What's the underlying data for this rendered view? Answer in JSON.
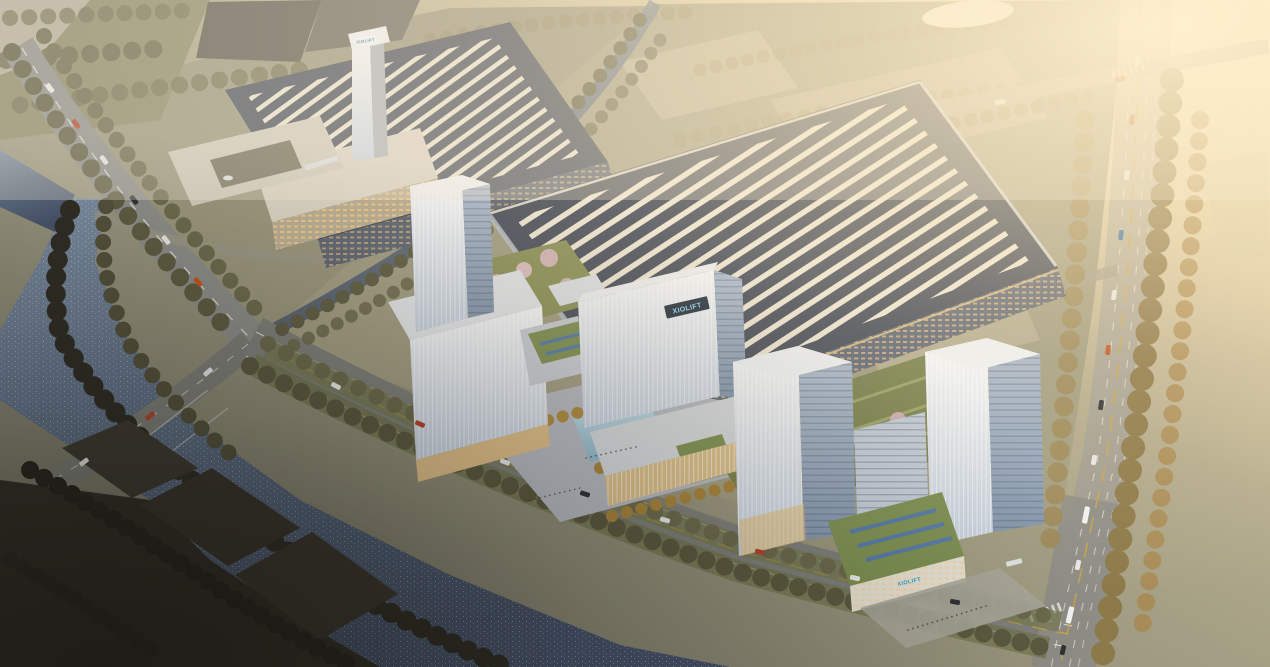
{
  "scene": {
    "brand": {
      "logo_text": "XIOLIFT",
      "logo_color": "#2d9fd8"
    },
    "palette": {
      "haze_gold": "#f9ecc8",
      "terrain_mid": "#93907a",
      "factory_roof": "#454c5a",
      "roof_stripe": "#ece5d3",
      "river_water": "#5d6d82",
      "pool_water": "#9ec6d8",
      "glass_light": "#f5f7f9",
      "glass_shade": "#8396ad",
      "podium_warm": "#e8c98f",
      "lawn_green": "#85895a",
      "green_roof": "#7d9052",
      "pv_strip": "#567aa8",
      "tree_olive": "#66644a",
      "tree_gold": "#a8854a",
      "tree_dark": "#302d25",
      "blossom_pink": "#dcbcc6",
      "road_gray": "#85867f",
      "lane_yellow": "#d2a63f"
    }
  }
}
